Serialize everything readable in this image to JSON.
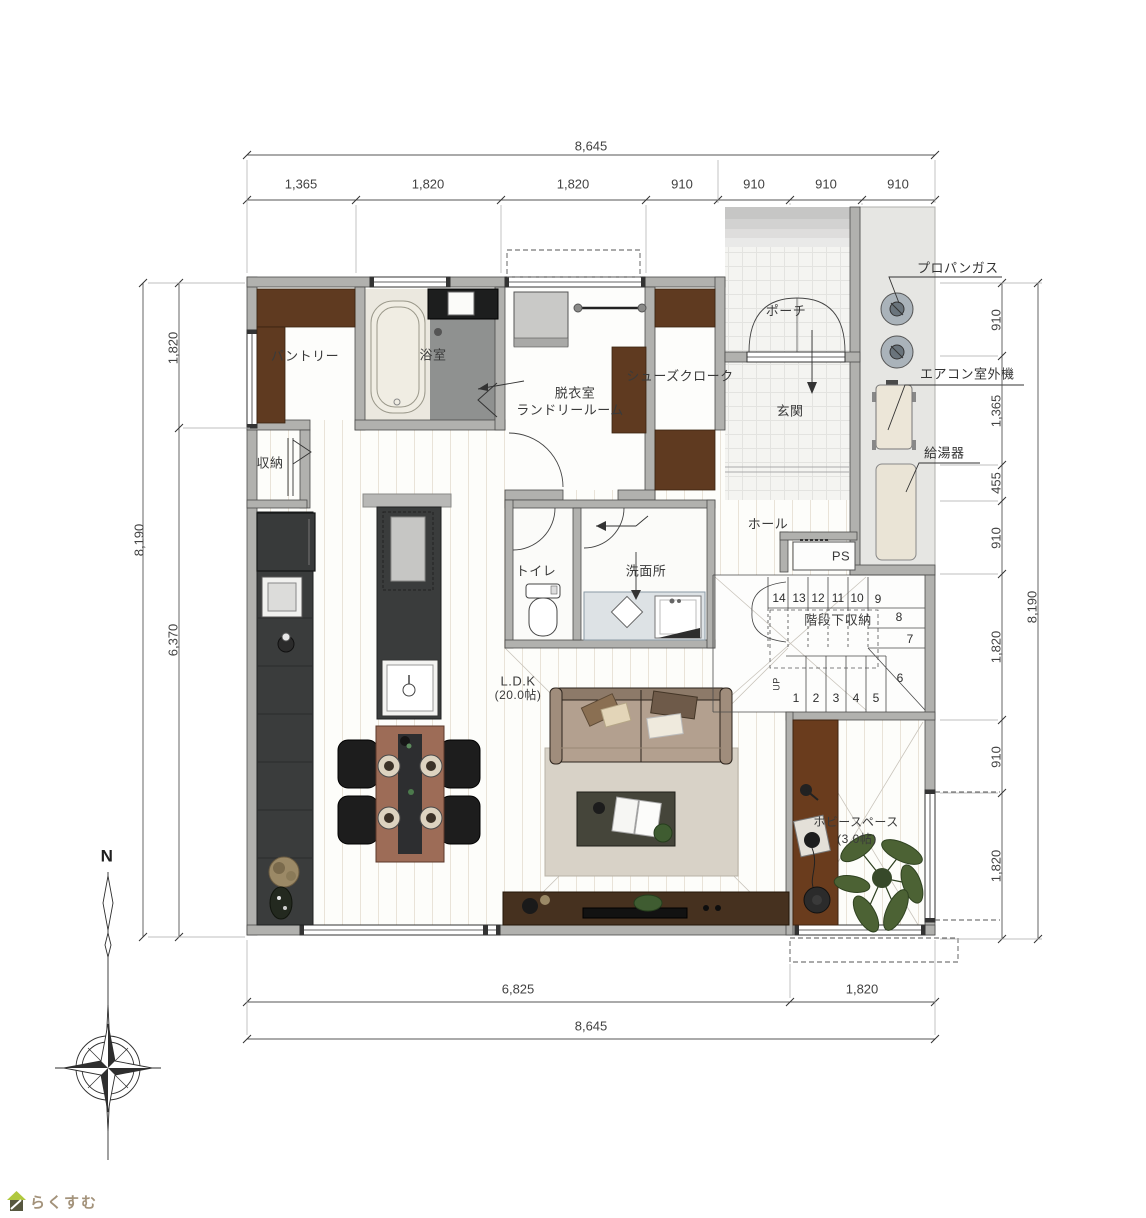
{
  "plan": {
    "rooms": {
      "pantry": "パントリー",
      "bath": "浴室",
      "dressing": "脱衣室",
      "laundry": "ランドリールーム",
      "shoe_closet": "シューズクローク",
      "entrance": "玄関",
      "porch": "ポーチ",
      "closet": "収納",
      "toilet": "トイレ",
      "washroom": "洗面所",
      "hall": "ホール",
      "ps": "PS",
      "under_stair_storage": "階段下収納",
      "ldk": "L.D.K",
      "ldk_area": "(20.0帖)",
      "hobby": "ホビースペース",
      "hobby_area": "(3.0帖)",
      "up": "UP"
    },
    "equipment": {
      "propane_gas": "プロパンガス",
      "ac_outdoor_unit": "エアコン室外機",
      "water_heater": "給湯器"
    },
    "dimensions": {
      "top_total": "8,645",
      "top_segments": [
        "1,365",
        "1,820",
        "1,820",
        "910",
        "910",
        "910",
        "910"
      ],
      "left_total": "8,190",
      "left_segments": [
        "1,820",
        "6,370"
      ],
      "right_total": "8,190",
      "right_segments": [
        "910",
        "1,365",
        "455",
        "910",
        "1,820",
        "910",
        "1,820"
      ],
      "bottom_segments": [
        "6,825",
        "1,820"
      ],
      "bottom_total": "8,645"
    },
    "stairs": {
      "upper_steps": [
        "14",
        "13",
        "12",
        "11",
        "10"
      ],
      "winder_steps": [
        "9",
        "8",
        "7",
        "6"
      ],
      "lower_steps": [
        "1",
        "2",
        "3",
        "4",
        "5"
      ]
    },
    "compass_north": "N",
    "logo_text": "らくすむ"
  }
}
